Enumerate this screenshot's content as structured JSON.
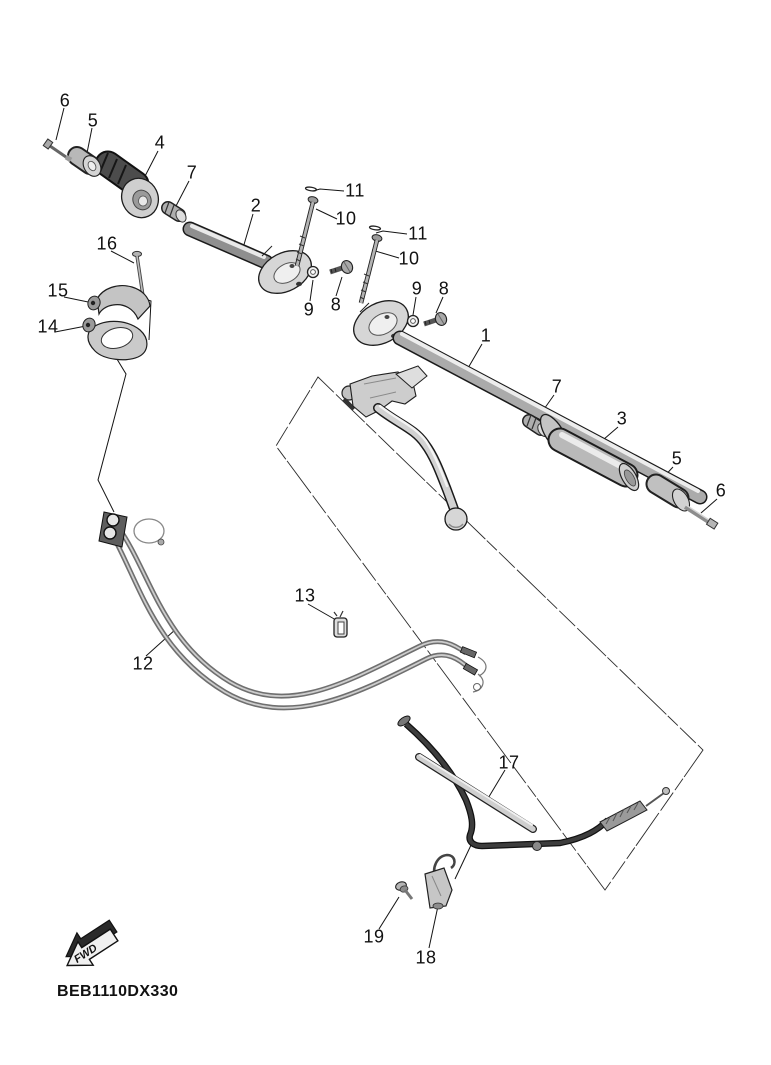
{
  "diagram": {
    "part_code": "BEB1110DX330",
    "fwd_label": "FWD",
    "callouts": [
      {
        "label": "6"
      },
      {
        "label": "5"
      },
      {
        "label": "4"
      },
      {
        "label": "7"
      },
      {
        "label": "2"
      },
      {
        "label": "16"
      },
      {
        "label": "15"
      },
      {
        "label": "14"
      },
      {
        "label": "11"
      },
      {
        "label": "10"
      },
      {
        "label": "11"
      },
      {
        "label": "10"
      },
      {
        "label": "9"
      },
      {
        "label": "8"
      },
      {
        "label": "9"
      },
      {
        "label": "8"
      },
      {
        "label": "1"
      },
      {
        "label": "7"
      },
      {
        "label": "3"
      },
      {
        "label": "5"
      },
      {
        "label": "6"
      },
      {
        "label": "12"
      },
      {
        "label": "13"
      },
      {
        "label": "17"
      },
      {
        "label": "19"
      },
      {
        "label": "18"
      }
    ]
  }
}
